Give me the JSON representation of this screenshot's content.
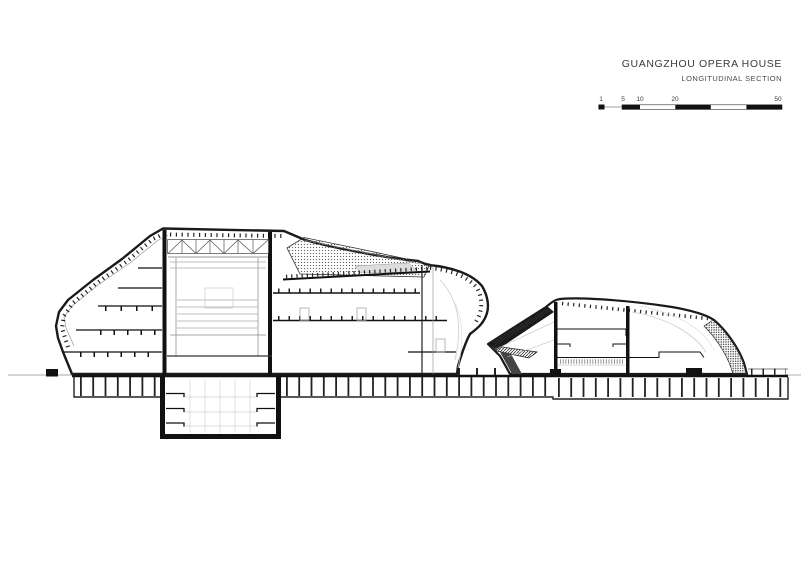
{
  "title_block": {
    "title": "GUANGZHOU OPERA HOUSE",
    "subtitle": "LONGITUDINAL SECTION"
  },
  "scale_bar": {
    "labels": [
      "1",
      "5",
      "10",
      "20",
      "50"
    ]
  },
  "palette": {
    "ink": "#1a1a1a",
    "line_gray": "#8a8a8a",
    "background": "#ffffff"
  }
}
